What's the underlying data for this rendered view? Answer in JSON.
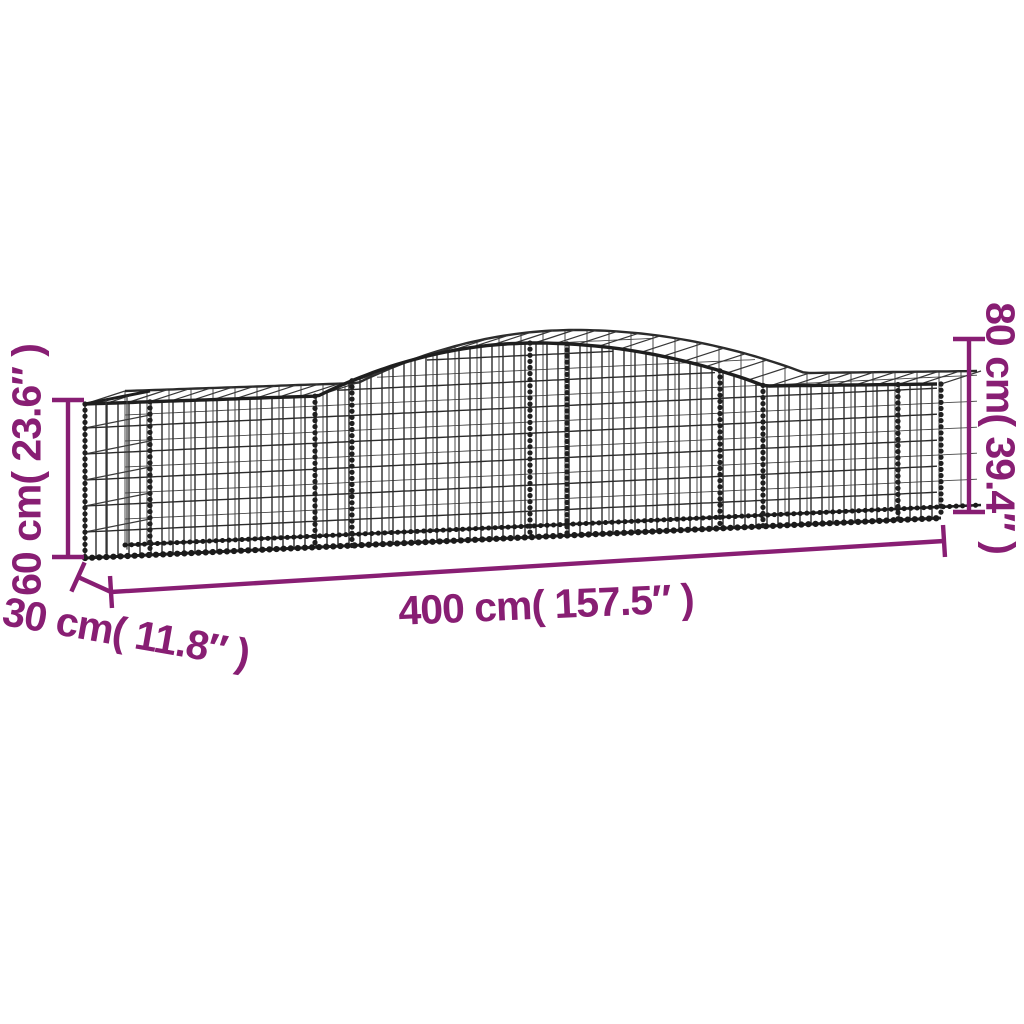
{
  "colors": {
    "accent": "#881E73",
    "wire": "#2b2b2b",
    "background": "#ffffff"
  },
  "dimensions": {
    "height_left": {
      "label": "60 cm( 23.6″ )",
      "value_cm": 60,
      "value_in": 23.6
    },
    "height_right": {
      "label": "80 cm( 39.4″ )",
      "value_cm": 80,
      "value_in": 39.4
    },
    "depth": {
      "label": "30 cm( 11.8″ )",
      "value_cm": 30,
      "value_in": 11.8
    },
    "length": {
      "label": "400 cm( 157.5″ )",
      "value_cm": 400,
      "value_in": 157.5
    }
  }
}
